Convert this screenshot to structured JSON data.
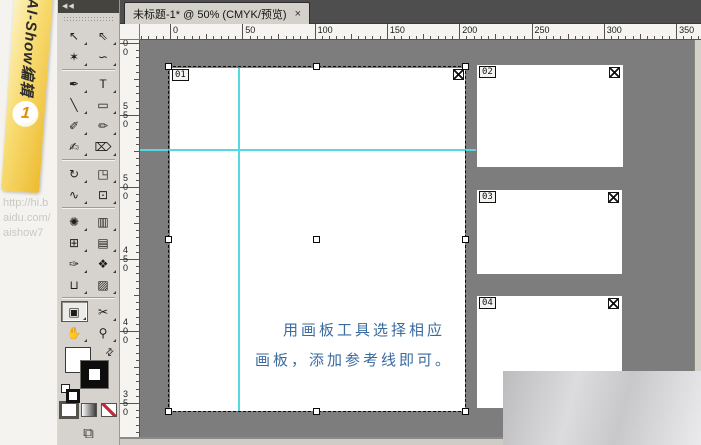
{
  "window": {
    "tab": {
      "title": "未标题-1* @ 50% (CMYK/预览)",
      "close_label": "×"
    }
  },
  "branding": {
    "ribbon_text": "AI-Show编辑",
    "ribbon_number": "1",
    "url_text": "http://hi.b\naidu.com/\naishow7"
  },
  "toolbar": {
    "collapse_label": "◀◀",
    "rows": [
      {
        "tools": [
          {
            "name": "selection-tool",
            "glyph": "↖"
          },
          {
            "name": "direct-selection-tool",
            "glyph": "⇖"
          }
        ]
      },
      {
        "tools": [
          {
            "name": "magic-wand-tool",
            "glyph": "✶"
          },
          {
            "name": "lasso-tool",
            "glyph": "∽"
          }
        ]
      },
      {
        "separator": true
      },
      {
        "tools": [
          {
            "name": "pen-tool",
            "glyph": "✒"
          },
          {
            "name": "type-tool",
            "glyph": "T"
          }
        ]
      },
      {
        "tools": [
          {
            "name": "line-segment-tool",
            "glyph": "╲"
          },
          {
            "name": "rectangle-tool",
            "glyph": "▭"
          }
        ]
      },
      {
        "tools": [
          {
            "name": "paintbrush-tool",
            "glyph": "✐"
          },
          {
            "name": "pencil-tool",
            "glyph": "✏"
          }
        ]
      },
      {
        "tools": [
          {
            "name": "blob-brush-tool",
            "glyph": "✍"
          },
          {
            "name": "eraser-tool",
            "glyph": "⌦"
          }
        ]
      },
      {
        "separator": true
      },
      {
        "tools": [
          {
            "name": "rotate-tool",
            "glyph": "↻"
          },
          {
            "name": "scale-tool",
            "glyph": "◳"
          }
        ]
      },
      {
        "tools": [
          {
            "name": "warp-tool",
            "glyph": "∿"
          },
          {
            "name": "free-transform-tool",
            "glyph": "⊡"
          }
        ]
      },
      {
        "separator": true
      },
      {
        "tools": [
          {
            "name": "symbol-sprayer-tool",
            "glyph": "✺"
          },
          {
            "name": "graph-tool",
            "glyph": "▥"
          }
        ]
      },
      {
        "tools": [
          {
            "name": "mesh-tool",
            "glyph": "⊞"
          },
          {
            "name": "gradient-tool",
            "glyph": "▤"
          }
        ]
      },
      {
        "tools": [
          {
            "name": "eyedropper-tool",
            "glyph": "✑"
          },
          {
            "name": "blend-tool",
            "glyph": "❖"
          }
        ]
      },
      {
        "tools": [
          {
            "name": "live-paint-bucket-tool",
            "glyph": "⊔"
          },
          {
            "name": "live-paint-selection-tool",
            "glyph": "▨"
          }
        ]
      },
      {
        "separator": true
      },
      {
        "tools": [
          {
            "name": "artboard-tool",
            "glyph": "▣",
            "selected": true
          },
          {
            "name": "slice-tool",
            "glyph": "✂"
          }
        ]
      },
      {
        "tools": [
          {
            "name": "hand-tool",
            "glyph": "✋"
          },
          {
            "name": "zoom-tool",
            "glyph": "⚲"
          }
        ]
      }
    ]
  },
  "rulers": {
    "horizontal": {
      "unit_labels": [
        "0",
        "50",
        "100",
        "150",
        "200",
        "250",
        "300",
        "350"
      ]
    },
    "vertical": {
      "unit_labels": [
        "600",
        "550",
        "500",
        "450",
        "400",
        "350"
      ]
    }
  },
  "canvas": {
    "artboards": [
      {
        "label": "01"
      },
      {
        "label": "02"
      },
      {
        "label": "03"
      },
      {
        "label": "04"
      }
    ],
    "note_lines": [
      "用画板工具选择相应",
      "画板，添加参考线即可。"
    ],
    "colors": {
      "guide": "#55d8e2",
      "note_text": "#3a6b9f",
      "canvas_bg": "#7d7d7d",
      "toolbar_bg": "#d6d3ce",
      "tabbar_bg": "#4e4e4e",
      "ribbon_gold": "#edbb31"
    }
  }
}
